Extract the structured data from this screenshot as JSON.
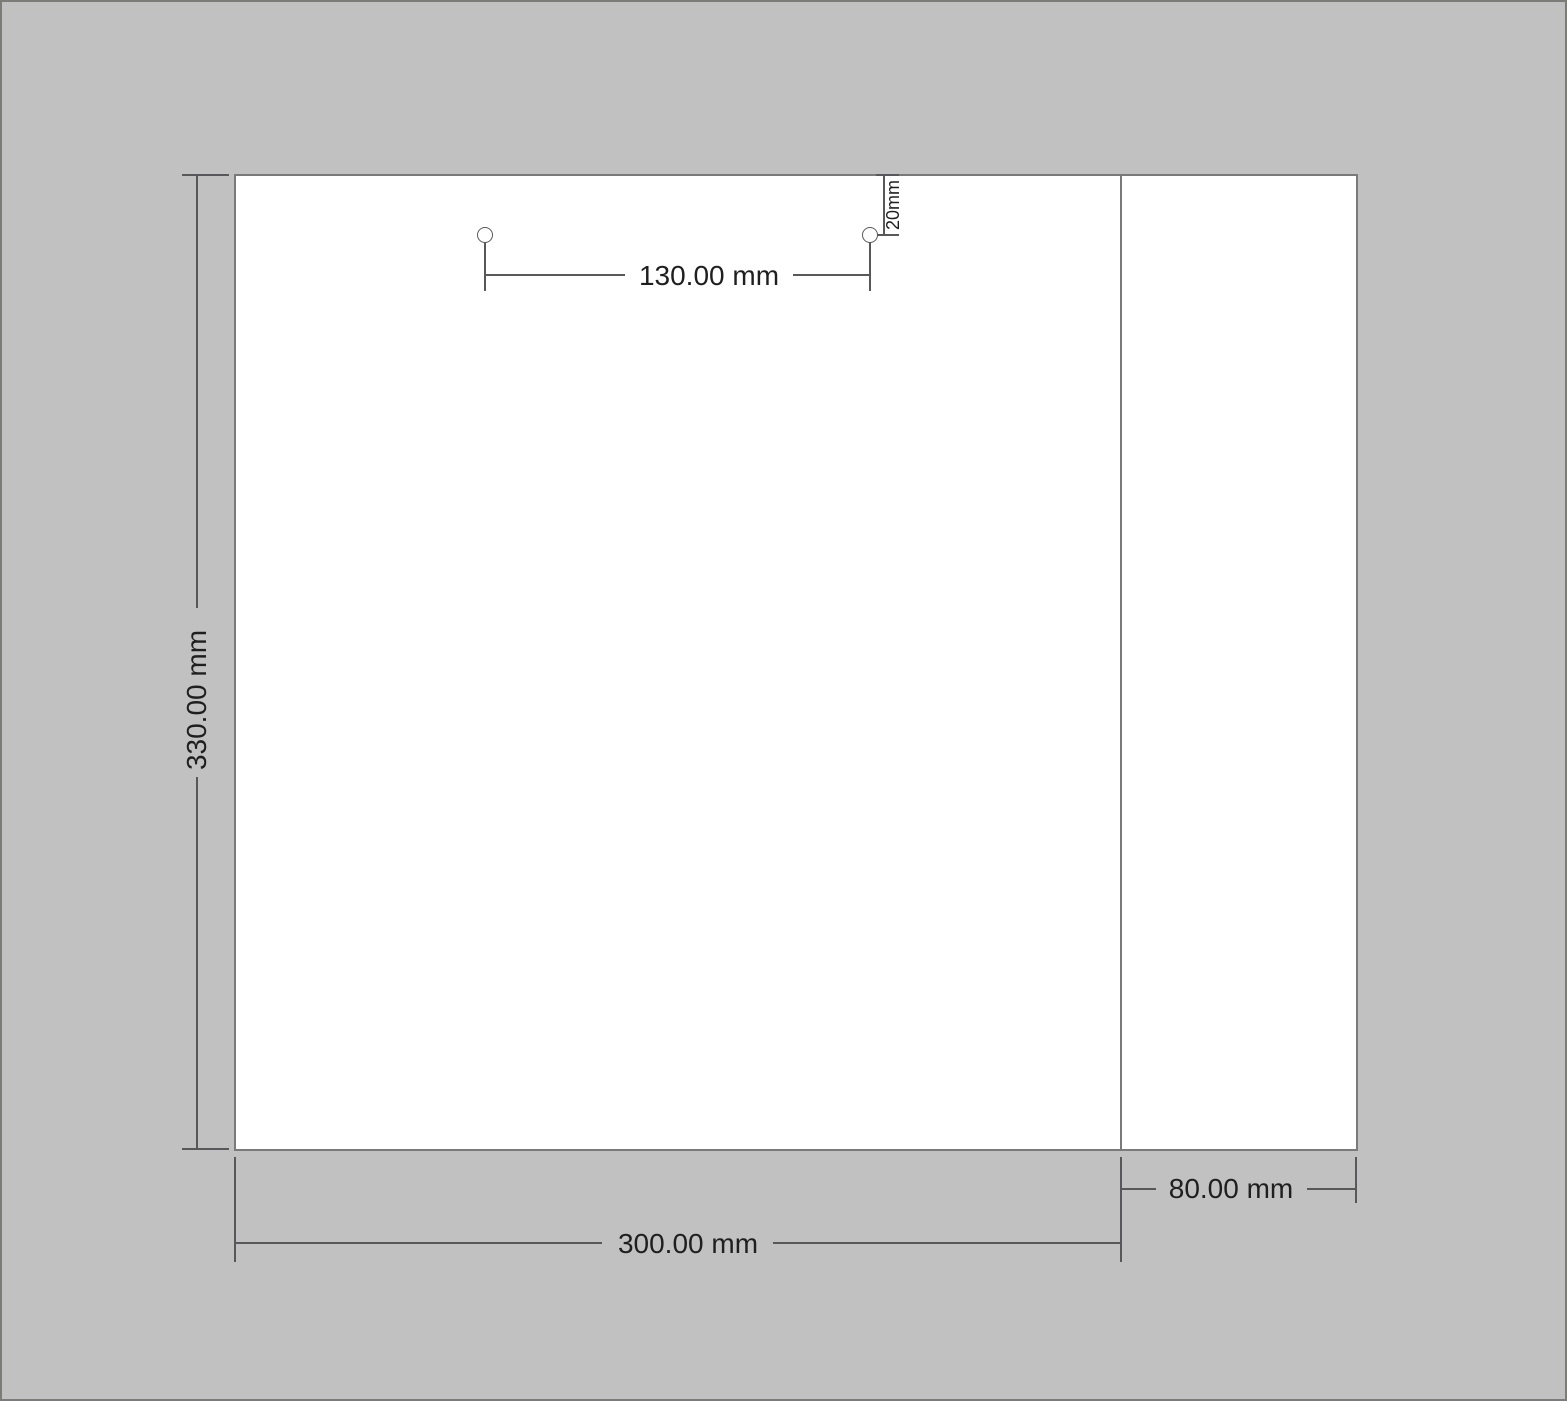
{
  "drawing": {
    "labels": {
      "height": "330.00 mm",
      "width": "300.00 mm",
      "flap_width": "80.00 mm",
      "hole_spacing": "130.00 mm",
      "hole_top_offset": "20mm"
    },
    "colors": {
      "background": "#c1c1c1",
      "panel_fill": "#ffffff",
      "panel_outline": "#7a7a7a",
      "dimension_line": "#58585a",
      "text": "#1f1f1f",
      "page_edge": "#7c7c77"
    }
  }
}
